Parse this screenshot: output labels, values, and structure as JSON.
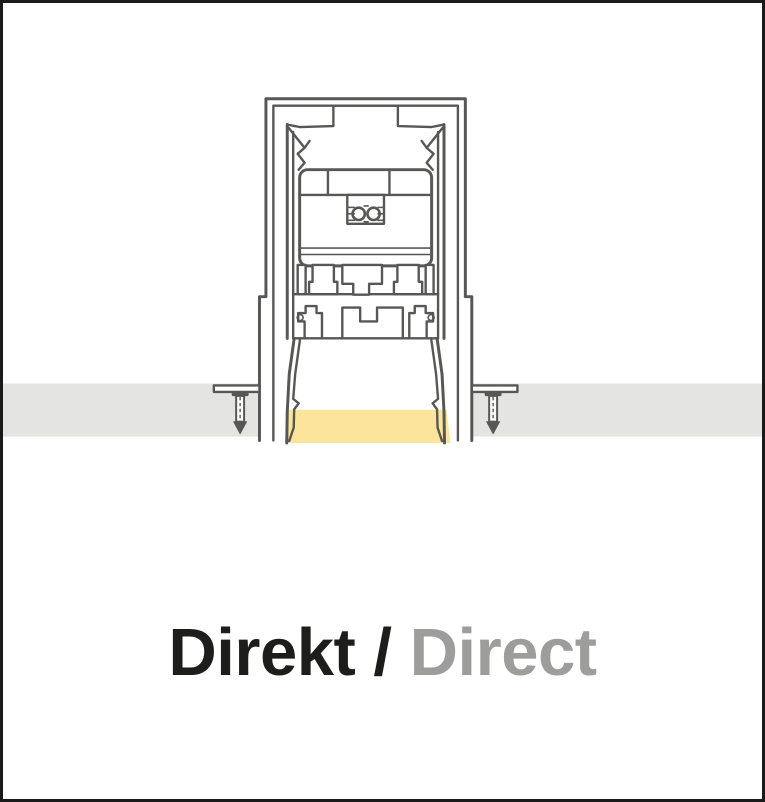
{
  "meta": {
    "description": "Technical cross-section diagram of a recessed linear profile luminaire emitting light downwards through the ceiling (direct lighting)"
  },
  "colors": {
    "line": "#575756",
    "ceiling": "#E4E4E3",
    "light_glow": "#FCE49B",
    "text_primary": "#1D1D1B",
    "text_secondary": "#9D9D9C",
    "frame_border": "#1A1A1A",
    "background": "#FFFFFF"
  },
  "caption": {
    "primary": "Direkt /",
    "secondary": "Direct"
  }
}
